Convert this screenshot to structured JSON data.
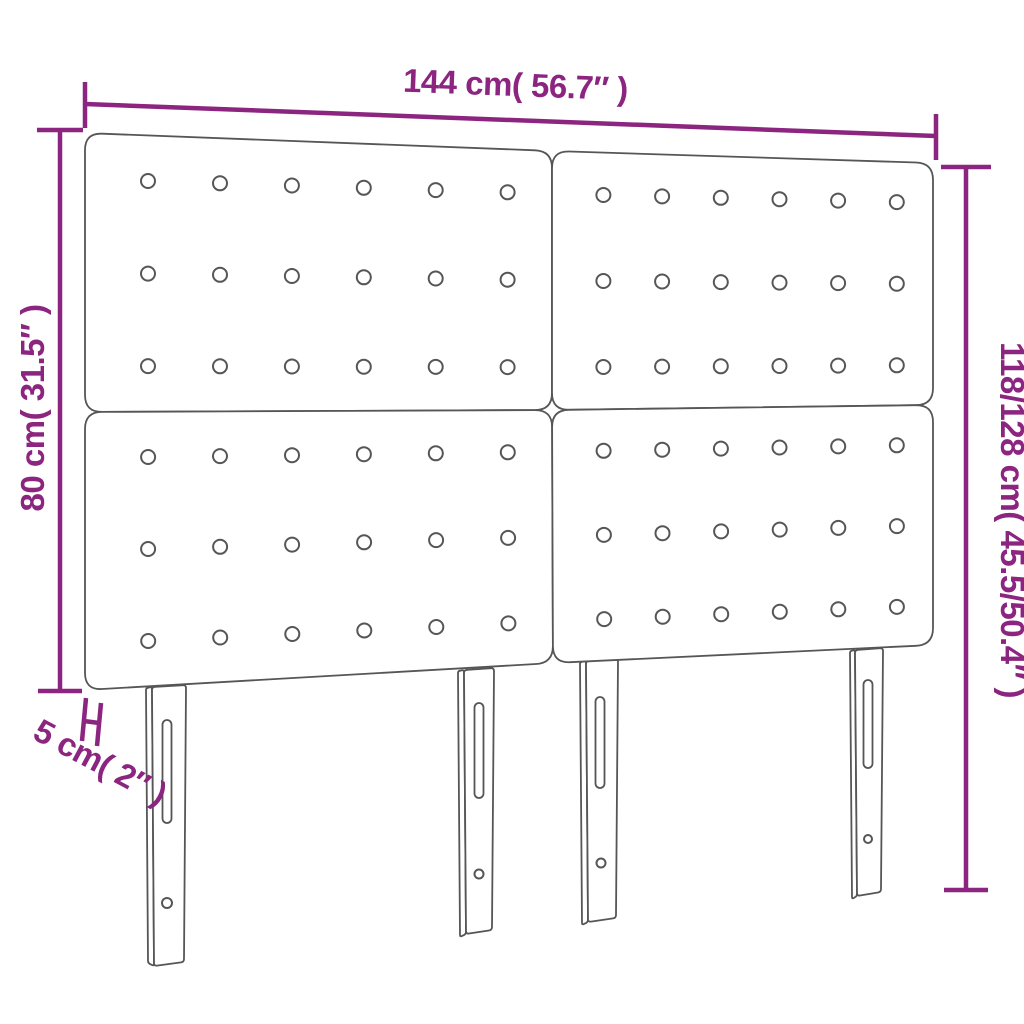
{
  "diagram": {
    "type": "product-dimension-diagram",
    "subject": "tufted headboard, 2x2 panels with buttons, 4 slotted legs",
    "labels": {
      "width": "144 cm( 56.7″ )",
      "height_left": "80 cm( 31.5″ )",
      "height_right": "118/128 cm( 45.5/50.4″ )",
      "thickness": "5 cm( 2″ )"
    },
    "measurements": {
      "width_cm": "144",
      "width_in": "56.7",
      "panel_height_cm": "80",
      "panel_height_in": "31.5",
      "total_height_cm": "118/128",
      "total_height_in": "45.5/50.4",
      "thickness_cm": "5",
      "thickness_in": "2"
    },
    "colors": {
      "dimension": "#8b2580",
      "outline": "#565656",
      "background": "#ffffff"
    },
    "structure": {
      "panel_rows": 2,
      "panel_cols": 2,
      "button_rows_per_panel": 3,
      "button_cols_per_panel": 6,
      "leg_count": 4
    }
  }
}
